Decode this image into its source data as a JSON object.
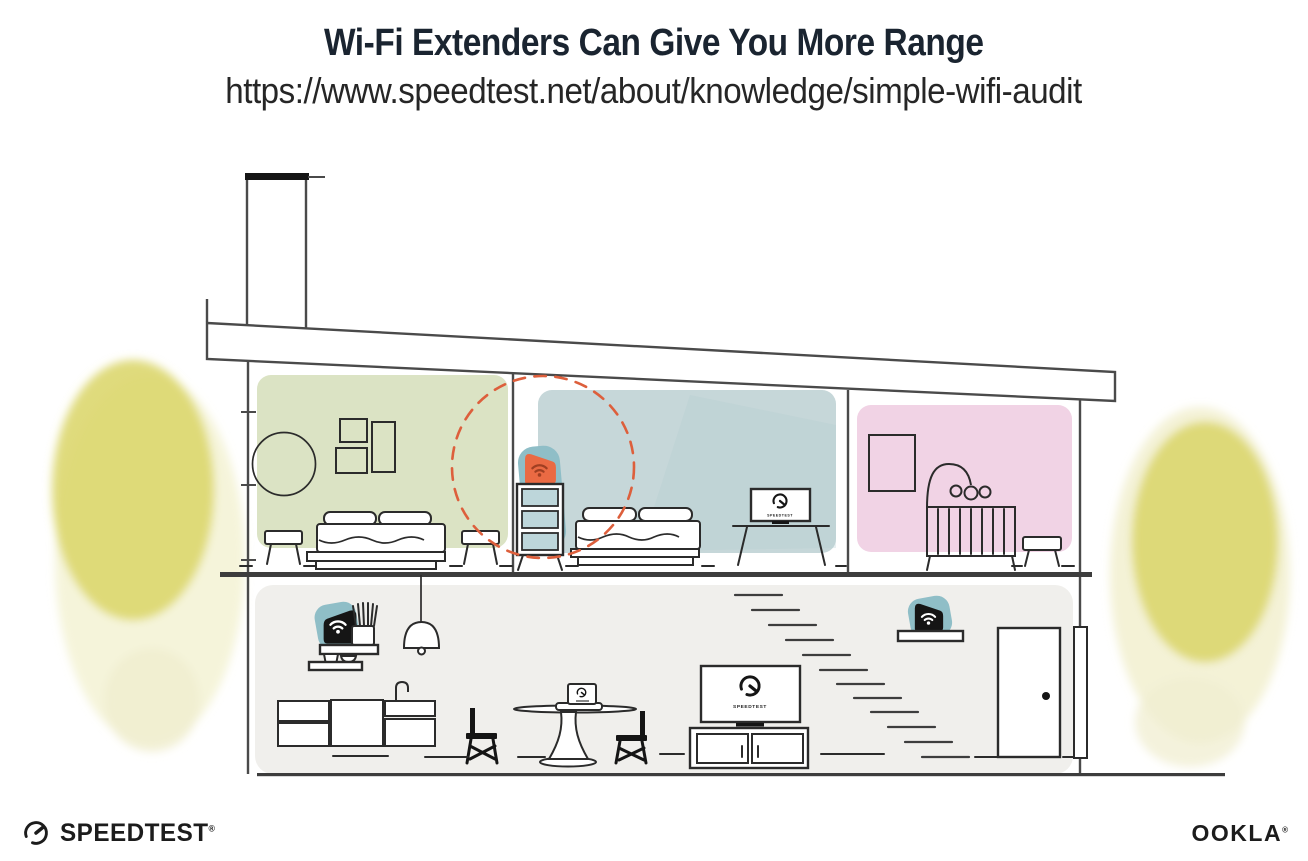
{
  "header": {
    "title": "Wi-Fi Extenders Can Give You More Range",
    "url": "https://www.speedtest.net/about/knowledge/simple-wifi-audit"
  },
  "illustration": {
    "tv_label": "SPEEDTEST"
  },
  "footer": {
    "speedtest_text": "SPEEDTEST",
    "speedtest_reg": "®",
    "ookla_text": "OOKLA",
    "ookla_reg": "®"
  },
  "colors": {
    "title_text": "#1a2430",
    "subtitle_text": "#262626",
    "structure_line": "#4a4a4a",
    "furniture_line": "#2b2b2b",
    "ink_black": "#151515",
    "room_green": "#dbe3c4",
    "room_blue": "#c6d7d9",
    "room_pink": "#f1d3e5",
    "downstairs_gray": "#f0efec",
    "device_teal": "#8fbec7",
    "drawer_teal": "#bdd6da",
    "device_orange": "#ea6a43",
    "wifi_on_orange": "#a03f22",
    "dashed_red": "#dd5f3c",
    "yellow_strong": "#dcd76e",
    "yellow_soft": "#e9e6ad",
    "yellow_faint": "#f0eed0",
    "floor_dark": "#3d3d3d"
  }
}
